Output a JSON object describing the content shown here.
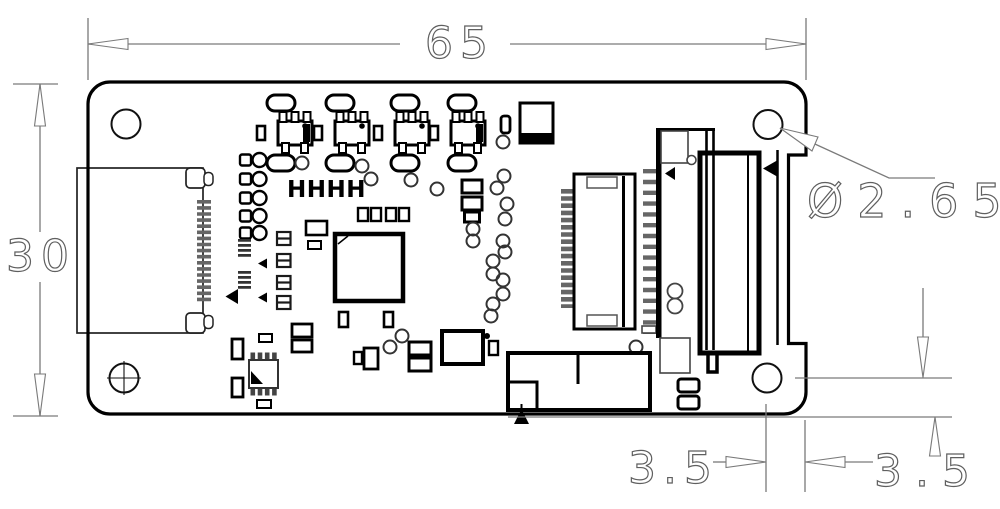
{
  "drawing": {
    "type": "pcb-mechanical-dimension-drawing",
    "silkscreen_label": "HHHH",
    "dimensions": {
      "board_width": "65",
      "board_height": "30",
      "hole_diameter": "Ø2.65",
      "hole_edge_offset_x": "3.5",
      "hole_edge_offset_y": "3.5"
    },
    "colors": {
      "outline": "#000000",
      "dimension_lines": "#7a7a7a",
      "dimension_text": "#5f5f5f",
      "background": "#ffffff"
    },
    "components": [
      "left-edge-connector",
      "ffc-connector",
      "vertical-fpc-connector",
      "card-edge-connector",
      "bottom-module",
      "main-ic",
      "soic8-ic",
      "mounting-hole-top-left",
      "mounting-hole-top-right",
      "mounting-hole-bottom-left",
      "mounting-hole-bottom-right"
    ]
  }
}
